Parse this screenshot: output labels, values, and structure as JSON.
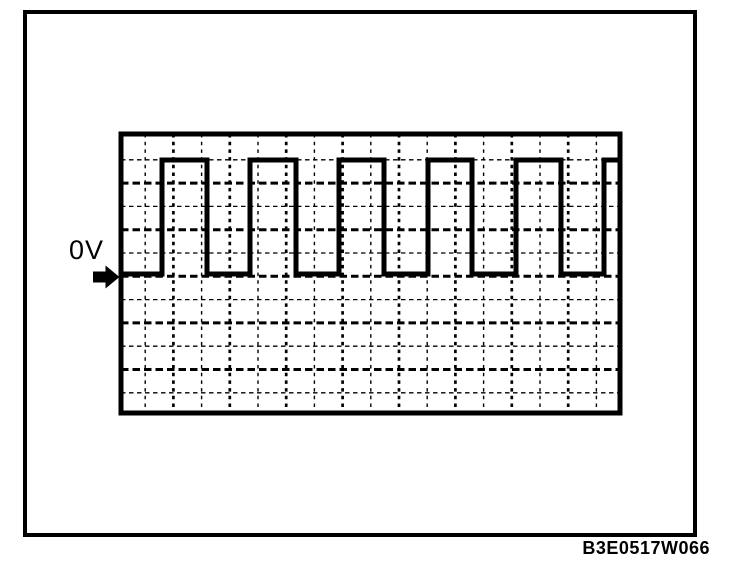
{
  "colors": {
    "ink": "#000000",
    "paper": "#ffffff"
  },
  "figure": {
    "zero_volt_label": "0V",
    "code": "B3E0517W066"
  },
  "chart_data": {
    "type": "line",
    "waveform_shape": "square",
    "title": "",
    "xlabel": "",
    "ylabel": "",
    "legend": [],
    "grid": "dashed oscilloscope graticule, 17 vertical x 11 horizontal internal lines, alternating light/heavy",
    "zero_reference": {
      "label": "0V",
      "at_level": "low"
    },
    "levels_rows": {
      "high_row": 0,
      "low_row": 4.9
    },
    "transitions_columns": {
      "rises": [
        0.6,
        3.7,
        6.9,
        10.0,
        13.2,
        16.3
      ],
      "falls": [
        2.2,
        5.3,
        8.5,
        11.6,
        14.7
      ]
    },
    "visible_pulses": 6,
    "duty_cycle_pct": 51,
    "starts_at": "low",
    "ends_at": "high"
  },
  "render": {
    "outer_border": {
      "x": 25,
      "y": 12,
      "width": 670,
      "height": 523,
      "stroke_width": 4
    },
    "screen": {
      "x": 121,
      "y": 134,
      "width": 499,
      "height": 279,
      "stroke_width": 5
    },
    "grid": {
      "v_start": 145.2,
      "v_spacing": 28.2,
      "v_count": 17,
      "h_start": 159.8,
      "h_spacing": 23.3,
      "h_count": 11
    },
    "trace": {
      "high_y": 160,
      "low_y": 274,
      "start_x": 121,
      "end_x": 619,
      "stroke_width": 5,
      "rises": [
        162,
        250,
        339,
        428,
        516,
        604
      ],
      "falls": [
        207,
        296,
        384,
        472,
        561
      ]
    }
  }
}
